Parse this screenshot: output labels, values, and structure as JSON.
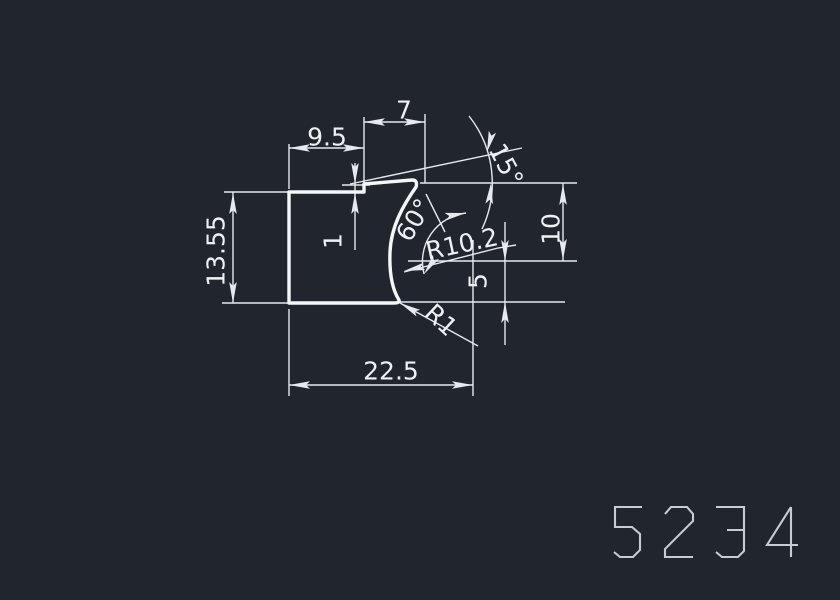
{
  "drawing": {
    "part_number": "5234",
    "dimensions": {
      "top_width_left": "9.5",
      "top_width_right": "7",
      "step_height": "1",
      "left_height": "13.55",
      "total_width": "22.5",
      "right_height_upper": "10",
      "right_height_lower": "5",
      "top_angle": "15°",
      "cove_angle": "60°",
      "cove_radius": "R10.2",
      "fillet_radius": "R1"
    },
    "colors": {
      "background": "#21262E",
      "profile_line": "#F4F6F8",
      "dimension_line": "#E6EAEE",
      "text": "#EEF1F4",
      "part_number": "#C6CCD3"
    }
  }
}
